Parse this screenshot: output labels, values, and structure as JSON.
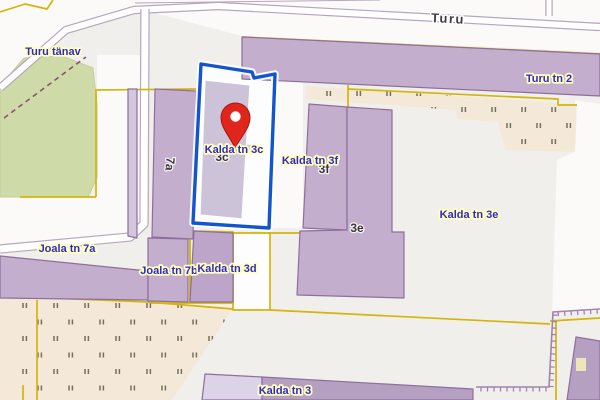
{
  "map": {
    "colors": {
      "bg": "#f1efeb",
      "white": "#fbfaf8",
      "green": "#cfdaa9",
      "beige": "#f4e9d9",
      "building_fill": "#c3aecd",
      "building_stroke": "#8d6f9c",
      "yellow": "#d3b50c",
      "road_casing": "#b7a6bf",
      "road_fill": "#ffffff",
      "selection_blue": "#1355cf",
      "selection_glow": "#ffffff",
      "wall": "#a183ae",
      "tick": "#73705f",
      "path_dash": "#8f4f6d",
      "label_blue": "#3129c6",
      "label_halo": "#ffffbd",
      "label_dark": "#3a3443",
      "label_dark_halo": "#f6f3ef",
      "marker_red": "#e0261c",
      "marker_dark": "#aa1710"
    },
    "white_areas": [
      {
        "name": "road-corridor-top",
        "points": [
          [
            0,
            0
          ],
          [
            600,
            0
          ],
          [
            600,
            52
          ],
          [
            242,
            36
          ],
          [
            140,
            9
          ],
          [
            68,
            28
          ],
          [
            0,
            86
          ]
        ]
      },
      {
        "name": "road-block-left",
        "points": [
          [
            97,
            55
          ],
          [
            140,
            55
          ],
          [
            140,
            237
          ],
          [
            0,
            250
          ],
          [
            0,
            197
          ],
          [
            97,
            197
          ]
        ]
      },
      {
        "name": "white-strip-right",
        "points": [
          [
            575,
            100
          ],
          [
            600,
            104
          ],
          [
            600,
            311
          ],
          [
            552,
            313
          ],
          [
            557,
            160
          ],
          [
            574,
            152
          ]
        ]
      },
      {
        "name": "selected-parcel-ground",
        "points": [
          [
            201,
            64
          ],
          [
            252,
            72
          ],
          [
            254,
            78
          ],
          [
            275,
            74
          ],
          [
            269,
            228
          ],
          [
            193,
            223
          ]
        ],
        "fill": "#fdfdfd"
      },
      {
        "name": "parcel-ground-c",
        "points": [
          [
            233,
            233
          ],
          [
            270,
            233
          ],
          [
            270,
            310
          ],
          [
            233,
            310
          ]
        ],
        "fill": "#fdfdfd"
      },
      {
        "name": "parcel-gap-strip",
        "points": [
          [
            276,
            75
          ],
          [
            303,
            78
          ],
          [
            303,
            228
          ],
          [
            270,
            228
          ]
        ]
      }
    ],
    "green_areas": [
      {
        "name": "park-turu-tanav",
        "points": [
          [
            0,
            86
          ],
          [
            24,
            58
          ],
          [
            62,
            56
          ],
          [
            93,
            68
          ],
          [
            97,
            104
          ],
          [
            97,
            178
          ],
          [
            88,
            197
          ],
          [
            0,
            197
          ]
        ]
      }
    ],
    "beige_areas": [
      {
        "name": "allotment-left",
        "points": [
          [
            0,
            296
          ],
          [
            148,
            302
          ],
          [
            233,
            309
          ],
          [
            230,
            313
          ],
          [
            172,
            400
          ],
          [
            0,
            400
          ]
        ]
      },
      {
        "name": "allotment-topright",
        "points": [
          [
            306,
            86
          ],
          [
            577,
            104
          ],
          [
            575,
            152
          ],
          [
            505,
            150
          ],
          [
            498,
            122
          ],
          [
            458,
            119
          ],
          [
            455,
            110
          ],
          [
            306,
            99
          ]
        ]
      }
    ],
    "tick_patterns": [
      {
        "name": "ticks-left",
        "area": 0,
        "y0": 303,
        "dy": 16.5,
        "rows": 6,
        "x0": 23,
        "xoff": 15,
        "dx": 31,
        "xmax": 236
      },
      {
        "name": "ticks-topright",
        "area": 1,
        "y0": 91,
        "dy": 16,
        "rows": 4,
        "x0": 327,
        "xoff": 15,
        "dx": 30,
        "xmax": 598
      }
    ],
    "roads": [
      {
        "name": "road-turu",
        "points": [
          [
            0,
            88
          ],
          [
            66,
            30
          ],
          [
            134,
            10
          ],
          [
            218,
            6
          ],
          [
            420,
            17
          ],
          [
            600,
            27
          ]
        ],
        "width": 6
      },
      {
        "name": "road-branch-north",
        "points": [
          [
            549,
            16
          ],
          [
            549,
            0
          ]
        ],
        "width": 5
      },
      {
        "name": "road-joala",
        "points": [
          [
            145,
            9
          ],
          [
            144,
            224
          ],
          [
            130,
            237
          ],
          [
            0,
            249
          ]
        ],
        "width": 7
      }
    ],
    "thin_lines": [
      {
        "name": "road-edge-top",
        "points": [
          [
            135,
            3
          ],
          [
            380,
            0
          ]
        ]
      }
    ],
    "dashed_paths": [
      {
        "name": "footpath-park",
        "points": [
          [
            4,
            118
          ],
          [
            86,
            57
          ]
        ],
        "dash": "5,4"
      }
    ],
    "yellow_lines": [
      {
        "name": "cadastral-topleft",
        "points": [
          [
            0,
            12
          ],
          [
            25,
            4
          ],
          [
            47,
            9
          ],
          [
            53,
            0
          ]
        ]
      },
      {
        "name": "cadastral-bldg-top",
        "points": [
          [
            242,
            37
          ],
          [
            600,
            54
          ]
        ]
      },
      {
        "name": "cadastral-bldg-bottom",
        "points": [
          [
            348,
            89
          ],
          [
            558,
            99
          ],
          [
            558,
            105
          ],
          [
            577,
            105
          ]
        ]
      },
      {
        "name": "cadastral-mid-vertical",
        "points": [
          [
            348,
            85
          ],
          [
            348,
            232
          ]
        ]
      },
      {
        "name": "cadastral-mid-horizontal",
        "points": [
          [
            268,
            233
          ],
          [
            348,
            233
          ]
        ]
      },
      {
        "name": "cadastral-parcel-a",
        "points": [
          [
            152,
            237
          ],
          [
            190,
            237
          ],
          [
            190,
            303
          ],
          [
            152,
            303
          ],
          [
            152,
            237
          ]
        ]
      },
      {
        "name": "cadastral-parcel-b",
        "points": [
          [
            190,
            231
          ],
          [
            233,
            232
          ],
          [
            233,
            303
          ],
          [
            190,
            303
          ],
          [
            190,
            231
          ]
        ]
      },
      {
        "name": "cadastral-parcel-c",
        "points": [
          [
            233,
            233
          ],
          [
            270,
            233
          ],
          [
            270,
            310
          ],
          [
            233,
            310
          ],
          [
            233,
            233
          ]
        ]
      },
      {
        "name": "cadastral-allotment-top",
        "points": [
          [
            0,
            296
          ],
          [
            148,
            302
          ],
          [
            233,
            309
          ]
        ]
      },
      {
        "name": "cadastral-vert-left",
        "points": [
          [
            37,
            300
          ],
          [
            37,
            400
          ]
        ]
      },
      {
        "name": "cadastral-vert-corner",
        "points": [
          [
            23,
            385
          ],
          [
            23,
            400
          ]
        ]
      },
      {
        "name": "cadastral-park-right",
        "points": [
          [
            96,
            89
          ],
          [
            96,
            197
          ]
        ]
      },
      {
        "name": "cadastral-park-bottom",
        "points": [
          [
            20,
            197
          ],
          [
            96,
            197
          ]
        ]
      },
      {
        "name": "cadastral-horiz-7a",
        "points": [
          [
            97,
            90
          ],
          [
            196,
            89
          ]
        ]
      },
      {
        "name": "cadastral-diag-bottom",
        "points": [
          [
            270,
            310
          ],
          [
            550,
            324
          ]
        ]
      },
      {
        "name": "cadastral-br-vertical",
        "points": [
          [
            556,
            322
          ],
          [
            556,
            400
          ]
        ]
      },
      {
        "name": "cadastral-br-horizontal",
        "points": [
          [
            550,
            321
          ],
          [
            600,
            318
          ]
        ]
      }
    ],
    "buildings": [
      {
        "name": "building-turu-tn-2",
        "points": [
          [
            242,
            37
          ],
          [
            600,
            54
          ],
          [
            600,
            96
          ],
          [
            242,
            79
          ]
        ]
      },
      {
        "name": "building-strip-west",
        "points": [
          [
            128,
            89
          ],
          [
            137,
            89
          ],
          [
            137,
            238
          ],
          [
            128,
            236
          ]
        ],
        "fill": "#d3c6de"
      },
      {
        "name": "building-7a",
        "points": [
          [
            155,
            89
          ],
          [
            196,
            91
          ],
          [
            193,
            239
          ],
          [
            152,
            237
          ]
        ]
      },
      {
        "name": "building-joala-7a",
        "points": [
          [
            0,
            256
          ],
          [
            148,
            271
          ],
          [
            148,
            300
          ],
          [
            0,
            298
          ]
        ]
      },
      {
        "name": "building-7b",
        "points": [
          [
            148,
            238
          ],
          [
            188,
            239
          ],
          [
            188,
            302
          ],
          [
            148,
            301
          ]
        ]
      },
      {
        "name": "building-3d",
        "points": [
          [
            194,
            231
          ],
          [
            233,
            233
          ],
          [
            233,
            302
          ],
          [
            190,
            302
          ]
        ],
        "fill": "#bda4c9"
      },
      {
        "name": "building-3f",
        "points": [
          [
            309,
            104
          ],
          [
            347,
            107
          ],
          [
            347,
            230
          ],
          [
            303,
            228
          ]
        ]
      },
      {
        "name": "building-3e",
        "points": [
          [
            347,
            107
          ],
          [
            392,
            110
          ],
          [
            392,
            232
          ],
          [
            404,
            232
          ],
          [
            404,
            298
          ],
          [
            297,
            295
          ],
          [
            300,
            231
          ],
          [
            347,
            230
          ]
        ]
      },
      {
        "name": "building-kalda-3-light",
        "points": [
          [
            205,
            374
          ],
          [
            262,
            377
          ],
          [
            262,
            400
          ],
          [
            202,
            400
          ]
        ],
        "fill": "#ddd3e8"
      },
      {
        "name": "building-kalda-3-dark",
        "points": [
          [
            262,
            377
          ],
          [
            473,
            389
          ],
          [
            473,
            400
          ],
          [
            262,
            400
          ]
        ],
        "fill": "#b5a0c2"
      },
      {
        "name": "building-bottom-right",
        "points": [
          [
            576,
            337
          ],
          [
            600,
            341
          ],
          [
            600,
            400
          ],
          [
            567,
            400
          ]
        ],
        "fill": "#b5a0c2"
      },
      {
        "name": "building-kalda-3c-selected",
        "points": [
          [
            205,
            80
          ],
          [
            250,
            85
          ],
          [
            242,
            219
          ],
          [
            200,
            215
          ]
        ],
        "fill": "#cdc3d8",
        "stroke": "#ffffff"
      }
    ],
    "selection": {
      "name": "selected-parcel-outline",
      "points": [
        [
          201,
          64
        ],
        [
          252,
          72
        ],
        [
          254,
          78
        ],
        [
          275,
          74
        ],
        [
          269,
          228
        ],
        [
          193,
          223
        ]
      ],
      "glow_width": 7.5,
      "stroke_width": 3.4
    },
    "walls": [
      {
        "name": "retaining-wall",
        "points": [
          [
            600,
            309
          ],
          [
            553,
            312
          ],
          [
            549,
            387
          ],
          [
            476,
            387
          ]
        ],
        "tick_len": 4.5,
        "tick_step": 6.5
      }
    ],
    "marker": {
      "name": "location-pin",
      "tip": [
        235,
        148
      ],
      "head": [
        235.5,
        117.5
      ],
      "radius": 14.5,
      "hole_radius": 5.2
    },
    "artifacts": [
      {
        "name": "clipped-label-halo",
        "x": 576,
        "y": 358,
        "w": 10,
        "h": 13,
        "fill": "#fdf6b8"
      }
    ],
    "labels": [
      {
        "text": "3c",
        "x": 222,
        "y": 157,
        "kind": "num",
        "name": "label-house-3c"
      },
      {
        "text": "3f",
        "x": 324,
        "y": 169,
        "kind": "num",
        "name": "label-house-3f"
      },
      {
        "text": "3e",
        "x": 357,
        "y": 228,
        "kind": "num",
        "name": "label-house-3e"
      },
      {
        "text": "7a",
        "x": 170,
        "y": 164,
        "kind": "num",
        "rot": 95,
        "name": "label-house-7a"
      },
      {
        "text": "Turu",
        "x": 448,
        "y": 19,
        "kind": "road",
        "rot": 3,
        "name": "label-street-turu"
      },
      {
        "text": "Turu tänav",
        "x": 53,
        "y": 51,
        "kind": "addr",
        "name": "label-addr-turu-tanav"
      },
      {
        "text": "Turu tn 2",
        "x": 549,
        "y": 78,
        "kind": "addr",
        "name": "label-addr-turu-tn-2"
      },
      {
        "text": "Kalda tn 3c",
        "x": 234,
        "y": 149,
        "kind": "addr",
        "name": "label-addr-kalda-tn-3c"
      },
      {
        "text": "Kalda tn 3f",
        "x": 310,
        "y": 160,
        "kind": "addr",
        "name": "label-addr-kalda-tn-3f"
      },
      {
        "text": "Kalda tn 3e",
        "x": 469,
        "y": 214,
        "kind": "addr",
        "name": "label-addr-kalda-tn-3e"
      },
      {
        "text": "Joala tn 7a",
        "x": 67,
        "y": 248,
        "kind": "addr",
        "name": "label-addr-joala-tn-7a"
      },
      {
        "text": "Joala tn 7b",
        "x": 169,
        "y": 270,
        "kind": "addr",
        "name": "label-addr-joala-tn-7b"
      },
      {
        "text": "Kalda tn 3d",
        "x": 227,
        "y": 268,
        "kind": "addr",
        "name": "label-addr-kalda-tn-3d"
      },
      {
        "text": "Kalda tn 3",
        "x": 285,
        "y": 390,
        "kind": "addr",
        "name": "label-addr-kalda-tn-3"
      }
    ]
  }
}
